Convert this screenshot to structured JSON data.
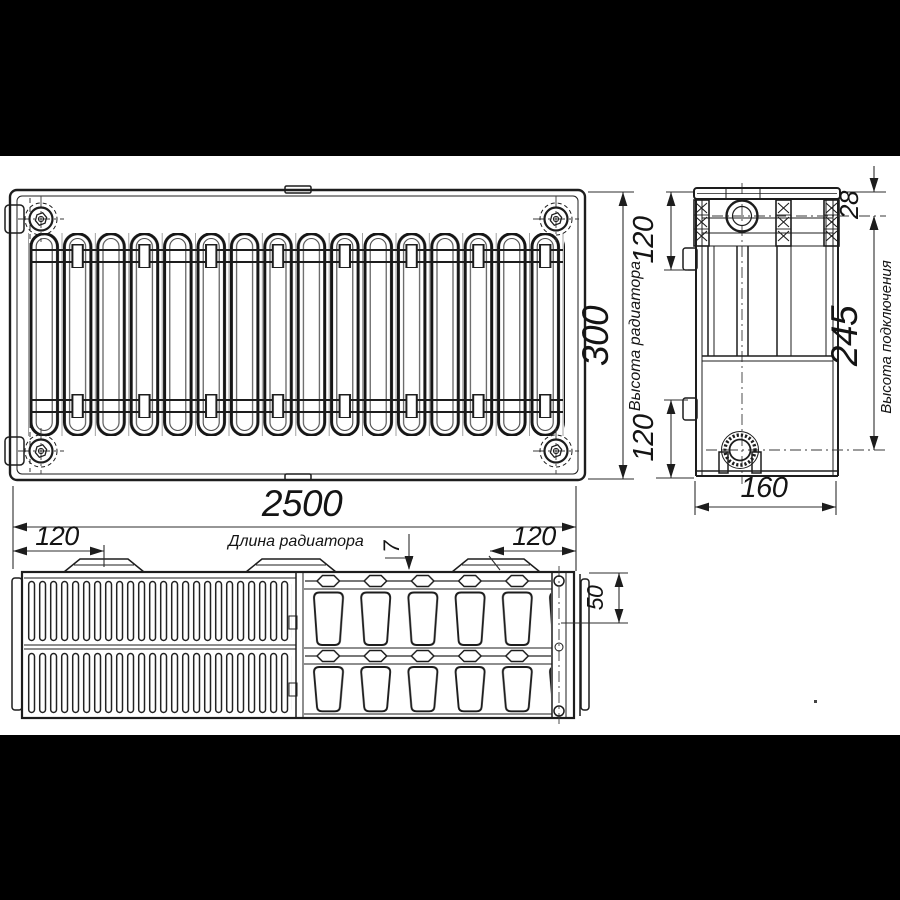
{
  "drawing": {
    "title": "radiator-dimension-drawing",
    "palette": {
      "ink": "#1d1d1d",
      "paper": "#ffffff",
      "letterbox": "#000000"
    },
    "labels": {
      "length": "2500",
      "length_caption": "Длина радиатора",
      "height": "300",
      "height_caption": "Высота радиатора",
      "depth": "160",
      "connection_height": "245",
      "connection_caption": "Высота подключения",
      "top_edge_to_axis": "28",
      "side_top_offset": "120",
      "side_bottom_offset": "120",
      "bracket_left_offset": "120",
      "bracket_right_offset": "120",
      "bracket_gap": "7",
      "panel_depth": "50"
    }
  }
}
